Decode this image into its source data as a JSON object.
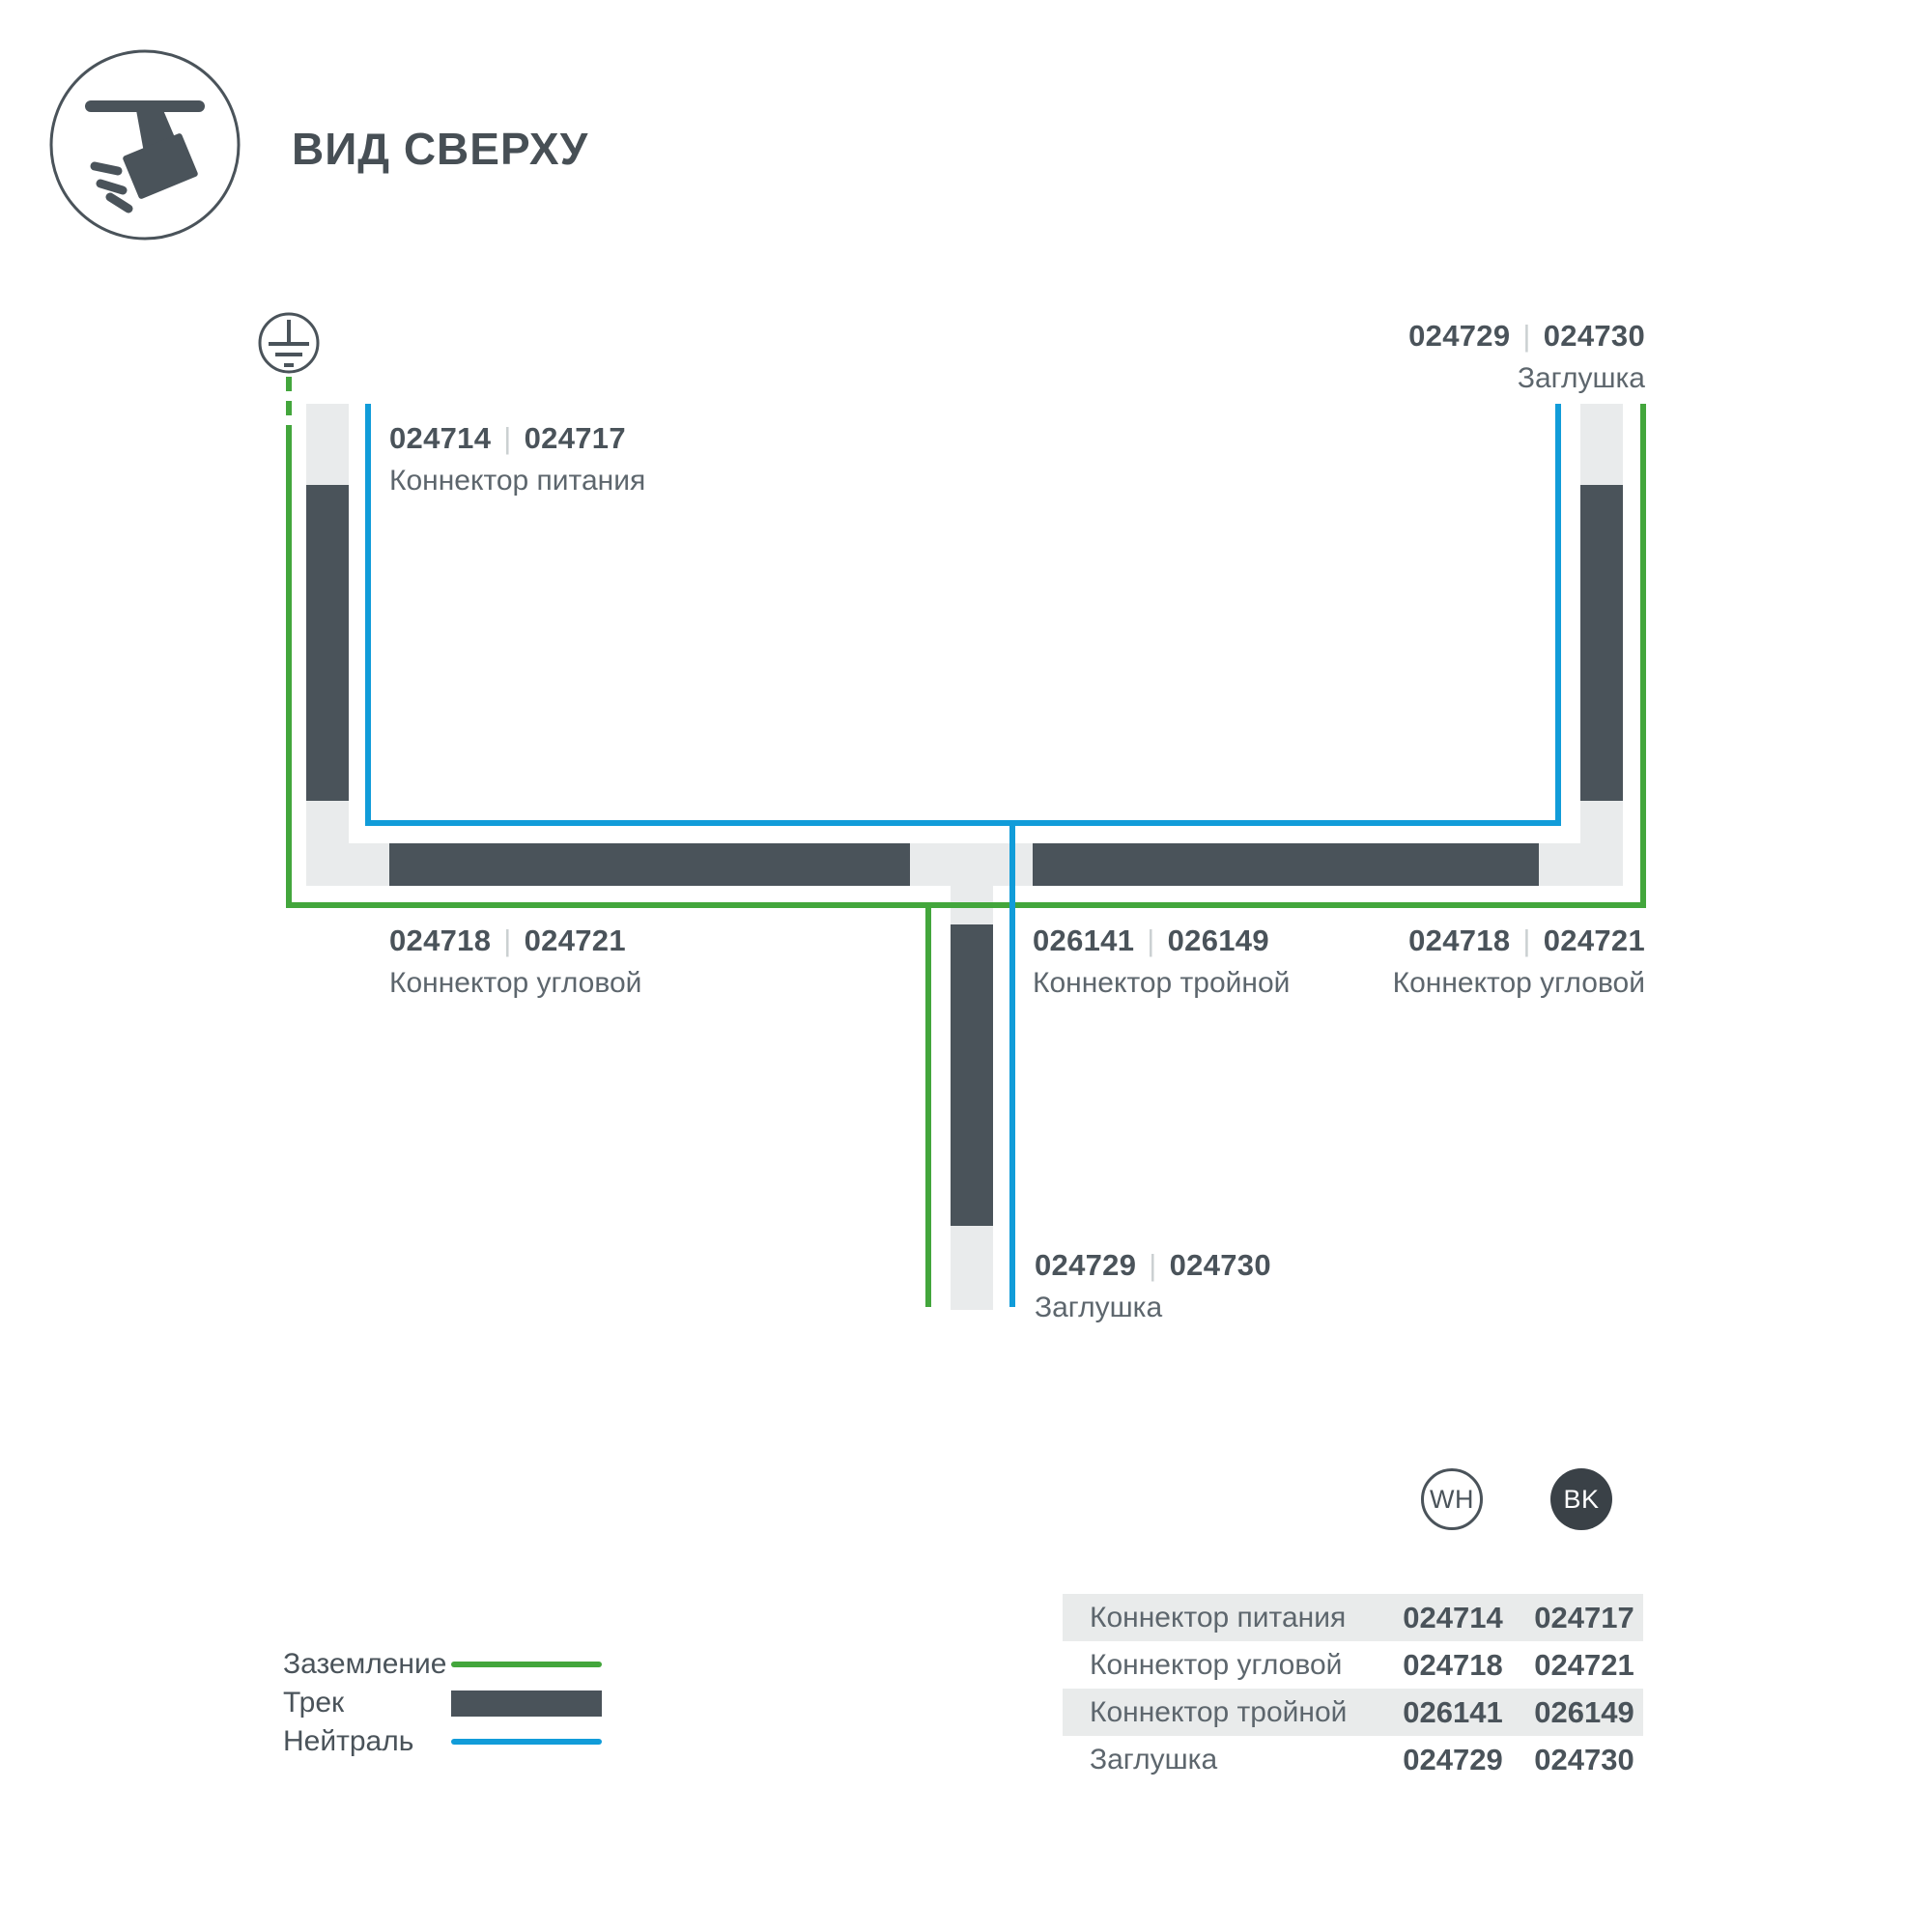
{
  "colors": {
    "dark": "#4a535a",
    "green": "#43a63c",
    "blue": "#119cd9",
    "track_base": "#e9ebec",
    "text_muted": "#5d666d",
    "separator_gray": "#cbd0d2",
    "bk_fill": "#3a4147"
  },
  "icons": {
    "header": "track-spotlight-icon",
    "ground": "earth-ground-icon"
  },
  "header": {
    "title": "ВИД СВЕРХУ"
  },
  "diagram": {
    "separator": "|",
    "labels": {
      "power": {
        "code_wh": "024714",
        "code_bk": "024717",
        "name": "Коннектор питания"
      },
      "endcap_top": {
        "code_wh": "024729",
        "code_bk": "024730",
        "name": "Заглушка"
      },
      "corner_left": {
        "code_wh": "024718",
        "code_bk": "024721",
        "name": "Коннектор угловой"
      },
      "triple": {
        "code_wh": "026141",
        "code_bk": "026149",
        "name": "Коннектор тройной"
      },
      "corner_right": {
        "code_wh": "024718",
        "code_bk": "024721",
        "name": "Коннектор угловой"
      },
      "endcap_bottom": {
        "code_wh": "024729",
        "code_bk": "024730",
        "name": "Заглушка"
      }
    }
  },
  "legend": {
    "items": [
      {
        "label": "Заземление",
        "swatch": "green-line"
      },
      {
        "label": "Трек",
        "swatch": "track-bar"
      },
      {
        "label": "Нейтраль",
        "swatch": "blue-line"
      }
    ]
  },
  "variants": {
    "wh": "WH",
    "bk": "BK"
  },
  "table": {
    "rows": [
      {
        "name": "Коннектор питания",
        "wh": "024714",
        "bk": "024717"
      },
      {
        "name": "Коннектор угловой",
        "wh": "024718",
        "bk": "024721"
      },
      {
        "name": "Коннектор тройной",
        "wh": "026141",
        "bk": "026149"
      },
      {
        "name": "Заглушка",
        "wh": "024729",
        "bk": "024730"
      }
    ]
  }
}
